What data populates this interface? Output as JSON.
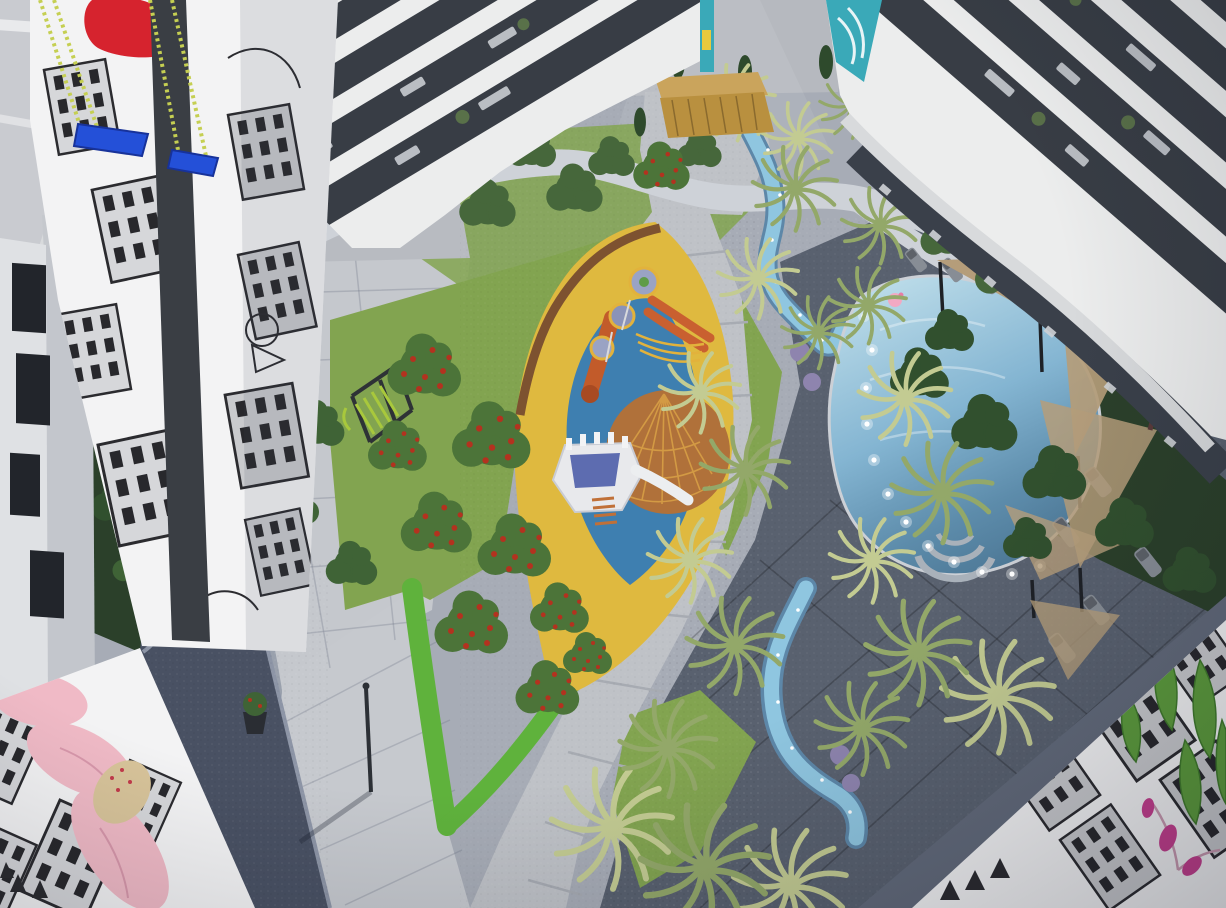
{
  "meta": {
    "description": "Aerial 3D architectural rendering of a residential courtyard at dusk: central playground, winding lit stream with palm rows, freeform pool with shade sails and loungers, artistic murals on building end-walls",
    "visible_text": "none"
  },
  "palette": {
    "road": "#c9cbd0",
    "road_stripe": "#e9eaec",
    "plaza_base": "#a7acb6",
    "plaza_lit": "#c5c8cd",
    "plaza_dark": "#59616f",
    "path": "#bfc2c7",
    "path_upper": "#b8bbc1",
    "walkway": "#ced2d8",
    "walkway_shaded": "#9aa1ad",
    "ramp_dark": "#495163",
    "gap_wall": "#b6b9bf",
    "building_white": "#eceded",
    "building_left": "#dfe1e4",
    "glass_dark": "#383d45",
    "terrace_dark": "#3a404a",
    "canopy_white": "#d8dadc",
    "mural_bg": "#f3f3f4",
    "mural_grey": "#d6d7da",
    "mural_grey2": "#c9cacd",
    "mural_line": "#2b2b2f",
    "mural_red": "#d6232e",
    "swing_blue": "#2450d8",
    "rope_green": "#c5cf52",
    "teal_mural": "#3aa9b8",
    "garden_dark": "#2b402a",
    "tree_dark": "#31502e",
    "tree_mid": "#4c7439",
    "tree_light": "#5d8a42",
    "berry_red": "#b3321f",
    "lawn": "#82a450",
    "hedge": "#5fb23c",
    "palm_light": "#c3cb92",
    "palm_mid": "#93a869",
    "palm_dark": "#73894f",
    "play_yellow": "#dfb93f",
    "play_blue": "#3e7fb0",
    "play_brown": "#b0713a",
    "web_orange": "#d39a44",
    "slide_orange": "#c25b2a",
    "wood_border": "#7d5230",
    "deck_wood": "#b9903f",
    "stream_blue": "#8fc6e0",
    "stream_deep": "#5d87a8",
    "pool_light": "#b9dae8",
    "pool_deep": "#4d7896",
    "sail_tan": "#b59d7a",
    "sail_dark": "#a08a67",
    "lavender": "#8e84ae",
    "pink_tree": "#d893bb",
    "pink_petal": "#f0bac6",
    "magenta": "#c53f8e",
    "lounger_grey": "#878d95",
    "lime_green": "#a8c83c",
    "metal_dark": "#2e3236",
    "car_dark": "#23262c",
    "slide_white": "#eceef0",
    "canopy_blue": "#5d6cb0"
  },
  "scene": {
    "objects": [
      "street-road",
      "left-building",
      "mural-tower-swings",
      "center-building",
      "right-building",
      "entrance-gate-deck",
      "courtyard-plaza",
      "elevated-walkway",
      "driveway-car",
      "left-garden",
      "center-berry-trees",
      "climbing-frame",
      "hedge",
      "lawn",
      "playground-surface",
      "play-structure-slides",
      "play-structure-ship",
      "spiderweb-climber",
      "walking-path",
      "stream-upper",
      "stream-lower",
      "palm-trees",
      "lavender-beds",
      "pool",
      "pool-lights",
      "pool-steps",
      "flamingo-float",
      "shade-sails",
      "sun-loungers",
      "pink-flowering-tree",
      "bottom-left-mural-flower",
      "bottom-right-mural-city",
      "lamp-post"
    ]
  }
}
